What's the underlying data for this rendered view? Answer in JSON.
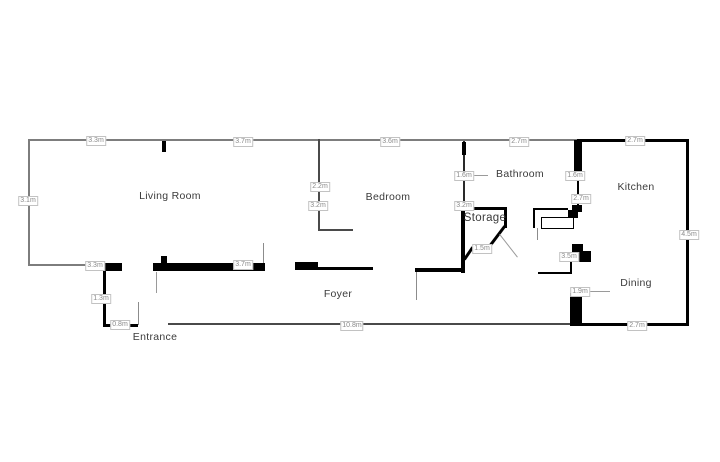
{
  "colors": {
    "wall_black": "#000000",
    "wall_gray": "#7d7d7d",
    "door_line_gray": "#8c8c8c",
    "dim_text": "#8a8a8a",
    "dim_border": "#c2c2c2",
    "room_text": "#3b3b3b",
    "background": "#ffffff"
  },
  "rooms": [
    {
      "name": "Living Room"
    },
    {
      "name": "Bedroom"
    },
    {
      "name": "Bathroom"
    },
    {
      "name": "Kitchen"
    },
    {
      "name": "Storage"
    },
    {
      "name": "Foyer"
    },
    {
      "name": "Dining"
    },
    {
      "name": "Entrance"
    }
  ],
  "dims": [
    {
      "text": "3.3m"
    },
    {
      "text": "3.7m"
    },
    {
      "text": "3.6m"
    },
    {
      "text": "2.7m"
    },
    {
      "text": "2.7m"
    },
    {
      "text": "3.1m"
    },
    {
      "text": "4.5m"
    },
    {
      "text": "3.3m"
    },
    {
      "text": "1.3m"
    },
    {
      "text": "0.8m"
    },
    {
      "text": "3.7m"
    },
    {
      "text": "10.8m"
    },
    {
      "text": "2.7m"
    },
    {
      "text": "2.2m"
    },
    {
      "text": "3.2m"
    },
    {
      "text": "1.6m"
    },
    {
      "text": "3.2m"
    },
    {
      "text": "1.5m"
    },
    {
      "text": "1.6m"
    },
    {
      "text": "2.7m"
    },
    {
      "text": "3.5m"
    },
    {
      "text": "1.9m"
    }
  ]
}
